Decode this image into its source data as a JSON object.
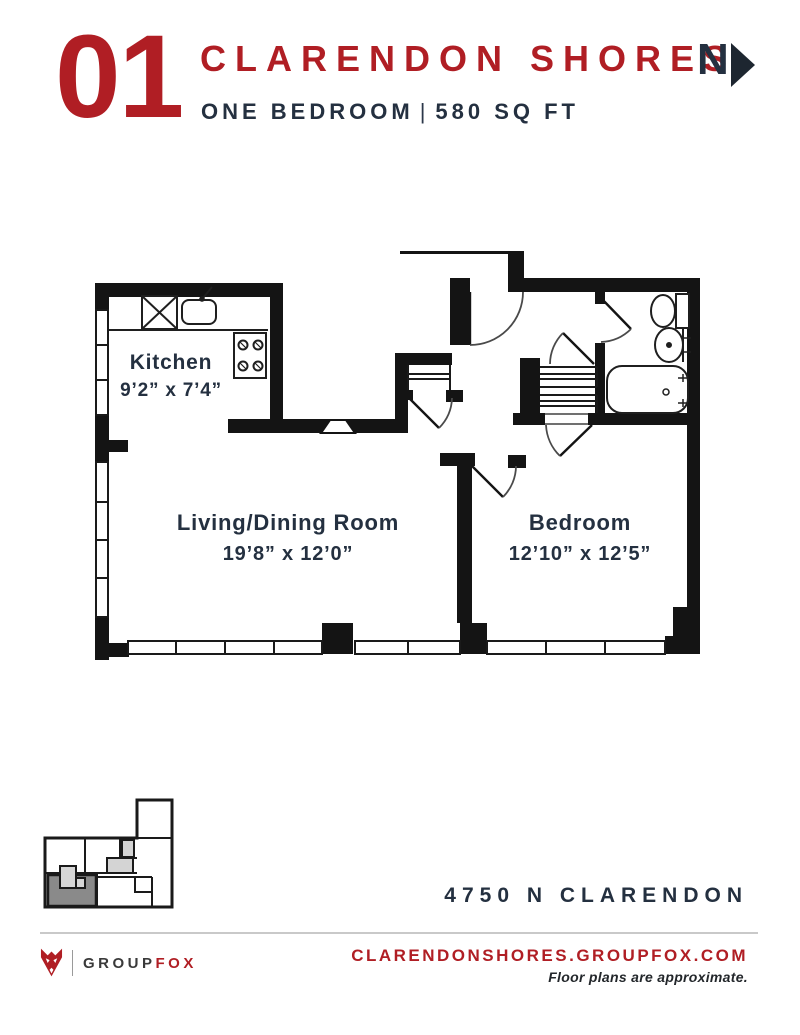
{
  "header": {
    "unit_number": "01",
    "property_name": "CLARENDON SHORES",
    "unit_type": "ONE BEDROOM",
    "separator": "|",
    "area": "580 SQ FT",
    "north_label": "N"
  },
  "floor_plan": {
    "rooms": [
      {
        "name": "Kitchen",
        "dimensions": "9’2” x 7’4”"
      },
      {
        "name": "Living/Dining Room",
        "dimensions": "19’8” x 12’0”"
      },
      {
        "name": "Bedroom",
        "dimensions": "12’10” x 12’5”"
      }
    ]
  },
  "address": "4750 N CLARENDON",
  "footer": {
    "brand_group": "GROUP",
    "brand_fox": "FOX",
    "website": "CLARENDONSHORES.GROUPFOX.COM",
    "disclaimer": "Floor plans are approximate."
  },
  "colors": {
    "brand_red": "#B01E24",
    "dark_navy": "#243040",
    "wall_black": "#141414",
    "key_plan_highlight": "#8A8A8A"
  }
}
